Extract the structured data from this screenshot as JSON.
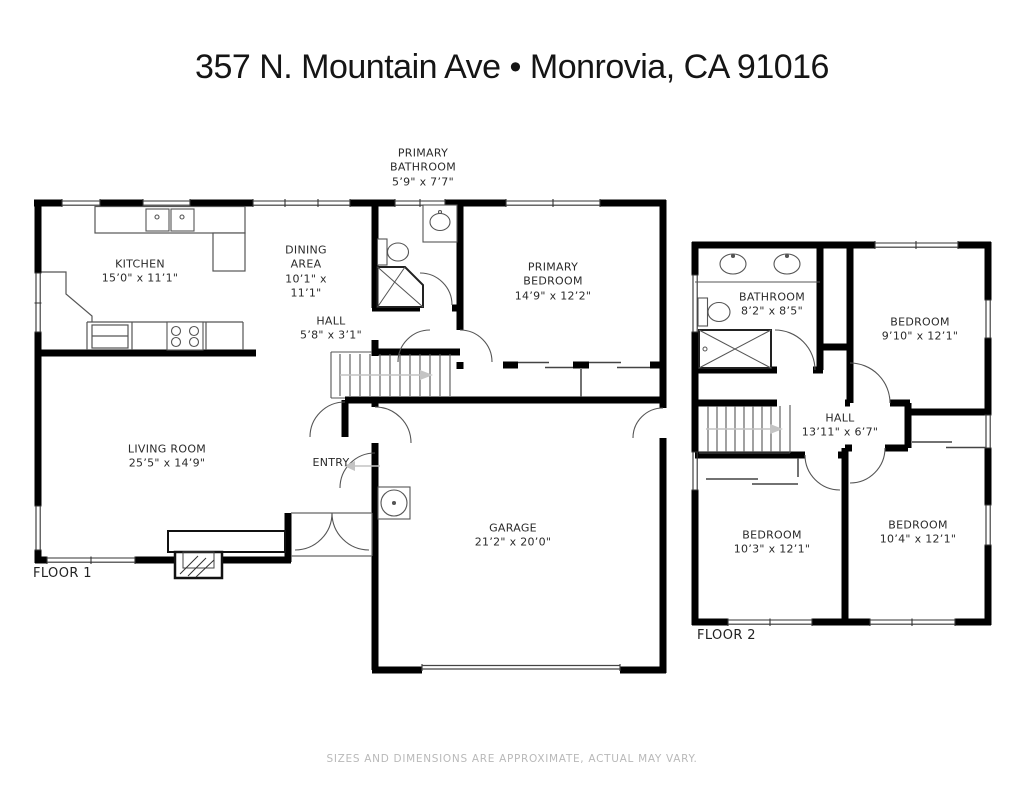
{
  "title": "357 N. Mountain Ave • Monrovia, CA 91016",
  "disclaimer": "SIZES AND DIMENSIONS ARE APPROXIMATE, ACTUAL MAY VARY.",
  "colors": {
    "wall": "#000000",
    "thin_line": "#555555",
    "arrow": "#c4c4c4",
    "label": "#2a2a2a",
    "muted": "#b9b9b9"
  },
  "floor1": {
    "label": "FLOOR 1",
    "rooms": {
      "primary_bathroom": {
        "name": "PRIMARY BATHROOM",
        "dims": "5’9\" x 7’7\""
      },
      "kitchen": {
        "name": "KITCHEN",
        "dims": "15’0\" x 11’1\""
      },
      "dining": {
        "name": "DINING AREA",
        "dims": "10’1\" x 11’1\""
      },
      "hall": {
        "name": "HALL",
        "dims": "5’8\" x 3’1\""
      },
      "primary_bedroom": {
        "name": "PRIMARY BEDROOM",
        "dims": "14’9\" x 12’2\""
      },
      "living": {
        "name": "LIVING ROOM",
        "dims": "25’5\" x 14’9\""
      },
      "entry": {
        "name": "ENTRY",
        "dims": ""
      },
      "garage": {
        "name": "GARAGE",
        "dims": "21’2\" x 20’0\""
      }
    }
  },
  "floor2": {
    "label": "FLOOR 2",
    "rooms": {
      "bathroom": {
        "name": "BATHROOM",
        "dims": "8’2\" x 8’5\""
      },
      "bedroom_top": {
        "name": "BEDROOM",
        "dims": "9’10\" x 12’1\""
      },
      "hall": {
        "name": "HALL",
        "dims": "13’11\" x 6’7\""
      },
      "bedroom_left": {
        "name": "BEDROOM",
        "dims": "10’3\" x 12’1\""
      },
      "bedroom_right": {
        "name": "BEDROOM",
        "dims": "10’4\" x 12’1\""
      }
    }
  }
}
